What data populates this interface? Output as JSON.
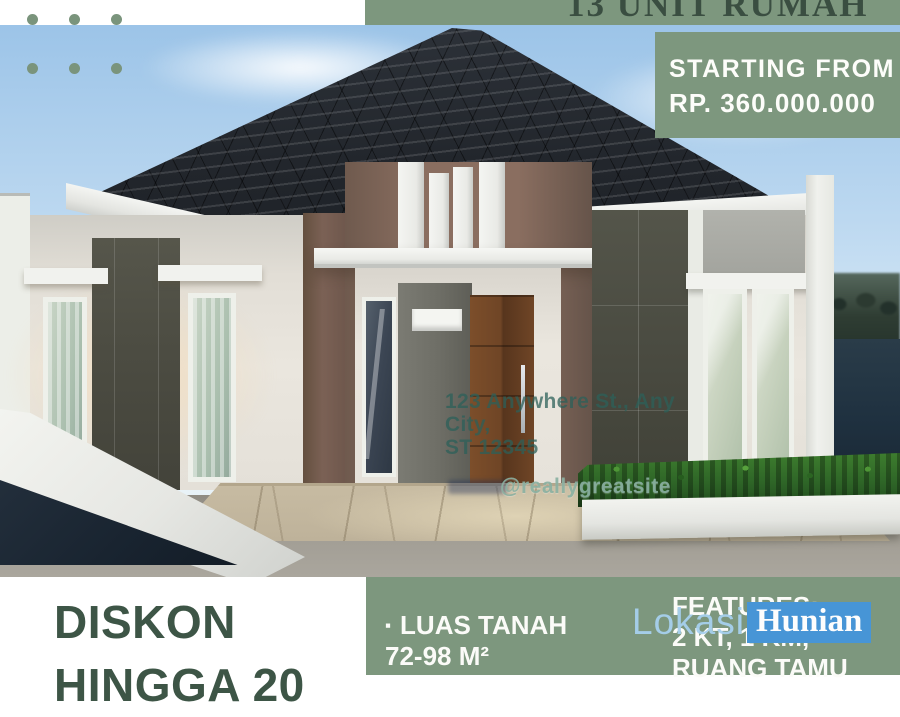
{
  "banner": {
    "title": "13 UNIT RUMAH"
  },
  "price_box": {
    "line1": "STARTING FROM",
    "line2": "RP. 360.000.000"
  },
  "discount": {
    "line1": "DISKON",
    "line2": "HINGGA 20"
  },
  "land_info": {
    "bullet": "▪",
    "label": "LUAS TANAH",
    "value": "72-98 M²"
  },
  "features": {
    "title": "FEATURES:",
    "line1": "2 KT, 1 KM,",
    "line2": "RUANG TAMU"
  },
  "watermarks": {
    "address_line1": "123 Anywhere St., Any City,",
    "address_line2": "ST 12345",
    "social": "@reallygreatsite",
    "brand_first": "Lokasi",
    "brand_second": "Hunian"
  },
  "colors": {
    "sage_green": "#7d977e",
    "dark_green_text": "#3d5546",
    "banner_text_green": "#3a4e41",
    "brand_blue": "#4795d6",
    "brand_light_blue": "#a7d0ee",
    "price_text": "#fdfdfa"
  }
}
